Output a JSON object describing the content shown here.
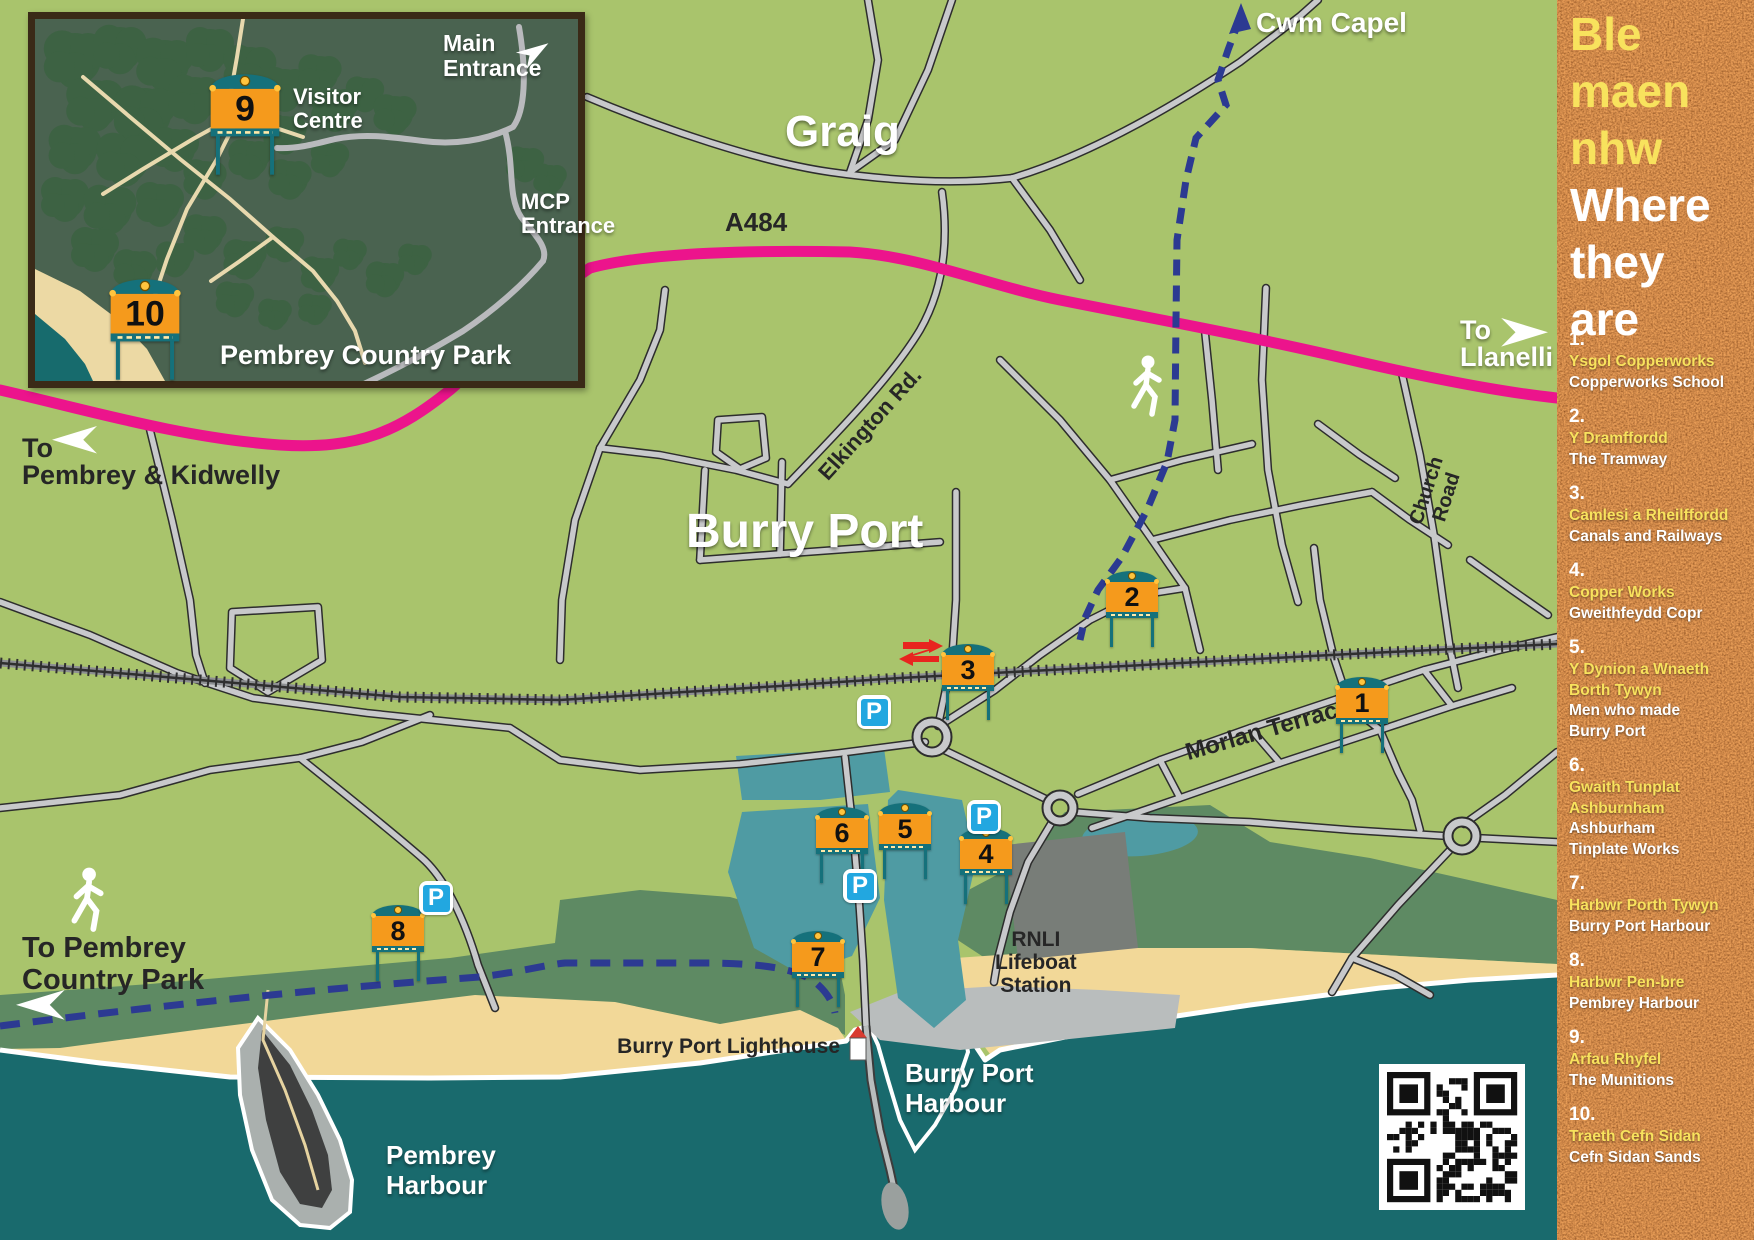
{
  "colors": {
    "map_green": "#a9c46c",
    "sea": "#196a6d",
    "harbour_water": "#4f9ba3",
    "sand": "#f2d898",
    "dune_green": "#5e8a63",
    "road_fill": "#c8c9cb",
    "road_outline": "#2d2d2d",
    "a_road_pink": "#ec148c",
    "trail_navy": "#2c3a92",
    "marker_orange": "#f59a1c",
    "marker_teal": "#15717b",
    "parking_blue": "#22a7e0",
    "sidebar_rust": "#8a3a10",
    "sidebar_yellow": "#f8e25d",
    "inset_green": "#4a6350"
  },
  "map": {
    "labels": {
      "graig": "Graig",
      "burry_port": "Burry Port",
      "cwm_capel": "Cwm Capel",
      "a484": "A484",
      "to_llanelli": [
        "To",
        "Llanelli"
      ],
      "to_pembrey_kidwelly": [
        "To",
        "Pembrey & Kidwelly"
      ],
      "to_pembrey_country_park": [
        "To Pembrey",
        "Country Park"
      ],
      "morlan_terrace": "Morlan Terrace",
      "elkington_rd": "Elkington Rd.",
      "church_road": [
        "Church",
        "Road"
      ],
      "rnli": [
        "RNLI",
        "Lifeboat",
        "Station"
      ],
      "burry_port_lighthouse": "Burry Port Lighthouse",
      "burry_port_harbour": [
        "Burry Port",
        "Harbour"
      ],
      "pembrey_harbour": [
        "Pembrey",
        "Harbour"
      ]
    }
  },
  "inset": {
    "title": "Pembrey Country Park",
    "labels": {
      "visitor_centre": [
        "Visitor",
        "Centre"
      ],
      "main_entrance": [
        "Main",
        "Entrance"
      ],
      "mcp_entrance": [
        "MCP",
        "Entrance"
      ]
    }
  },
  "markers": {
    "main": [
      {
        "num": "1",
        "x": 1362,
        "y": 704
      },
      {
        "num": "2",
        "x": 1132,
        "y": 598
      },
      {
        "num": "3",
        "x": 968,
        "y": 671
      },
      {
        "num": "4",
        "x": 986,
        "y": 855
      },
      {
        "num": "5",
        "x": 905,
        "y": 830
      },
      {
        "num": "6",
        "x": 842,
        "y": 834
      },
      {
        "num": "7",
        "x": 818,
        "y": 958
      },
      {
        "num": "8",
        "x": 398,
        "y": 932
      }
    ],
    "inset": [
      {
        "num": "9",
        "x": 210,
        "y": 91
      },
      {
        "num": "10",
        "x": 110,
        "y": 296
      }
    ]
  },
  "parking": {
    "label": "P",
    "locations": [
      {
        "x": 874,
        "y": 712
      },
      {
        "x": 984,
        "y": 817
      },
      {
        "x": 860,
        "y": 886
      },
      {
        "x": 436,
        "y": 898
      }
    ]
  },
  "sidebar": {
    "title_welsh_lines": [
      "Ble",
      "maen",
      "nhw"
    ],
    "title_english_lines": [
      "Where",
      "they",
      "are"
    ],
    "items": [
      {
        "num": "1.",
        "welsh": [
          "Ysgol Copperworks"
        ],
        "english": [
          "Copperworks School"
        ]
      },
      {
        "num": "2.",
        "welsh": [
          "Y Dramffordd"
        ],
        "english": [
          "The Tramway"
        ]
      },
      {
        "num": "3.",
        "welsh": [
          "Camlesi a Rheilffordd"
        ],
        "english": [
          "Canals and Railways"
        ]
      },
      {
        "num": "4.",
        "welsh": [
          "Copper Works"
        ],
        "english": [
          "Gweithfeydd Copr"
        ]
      },
      {
        "num": "5.",
        "welsh": [
          "Y Dynion a Wnaeth",
          "Borth Tywyn"
        ],
        "english": [
          "Men who made",
          "Burry Port"
        ]
      },
      {
        "num": "6.",
        "welsh": [
          "Gwaith Tunplat",
          "Ashburnham"
        ],
        "english": [
          "Ashburham",
          "Tinplate Works"
        ]
      },
      {
        "num": "7.",
        "welsh": [
          "Harbwr Porth Tywyn"
        ],
        "english": [
          "Burry Port Harbour"
        ]
      },
      {
        "num": "8.",
        "welsh": [
          "Harbwr Pen-bre"
        ],
        "english": [
          "Pembrey Harbour"
        ]
      },
      {
        "num": "9.",
        "welsh": [
          "Arfau Rhyfel"
        ],
        "english": [
          "The Munitions"
        ]
      },
      {
        "num": "10.",
        "welsh": [
          "Traeth Cefn Sidan"
        ],
        "english": [
          "Cefn Sidan Sands"
        ]
      }
    ]
  }
}
